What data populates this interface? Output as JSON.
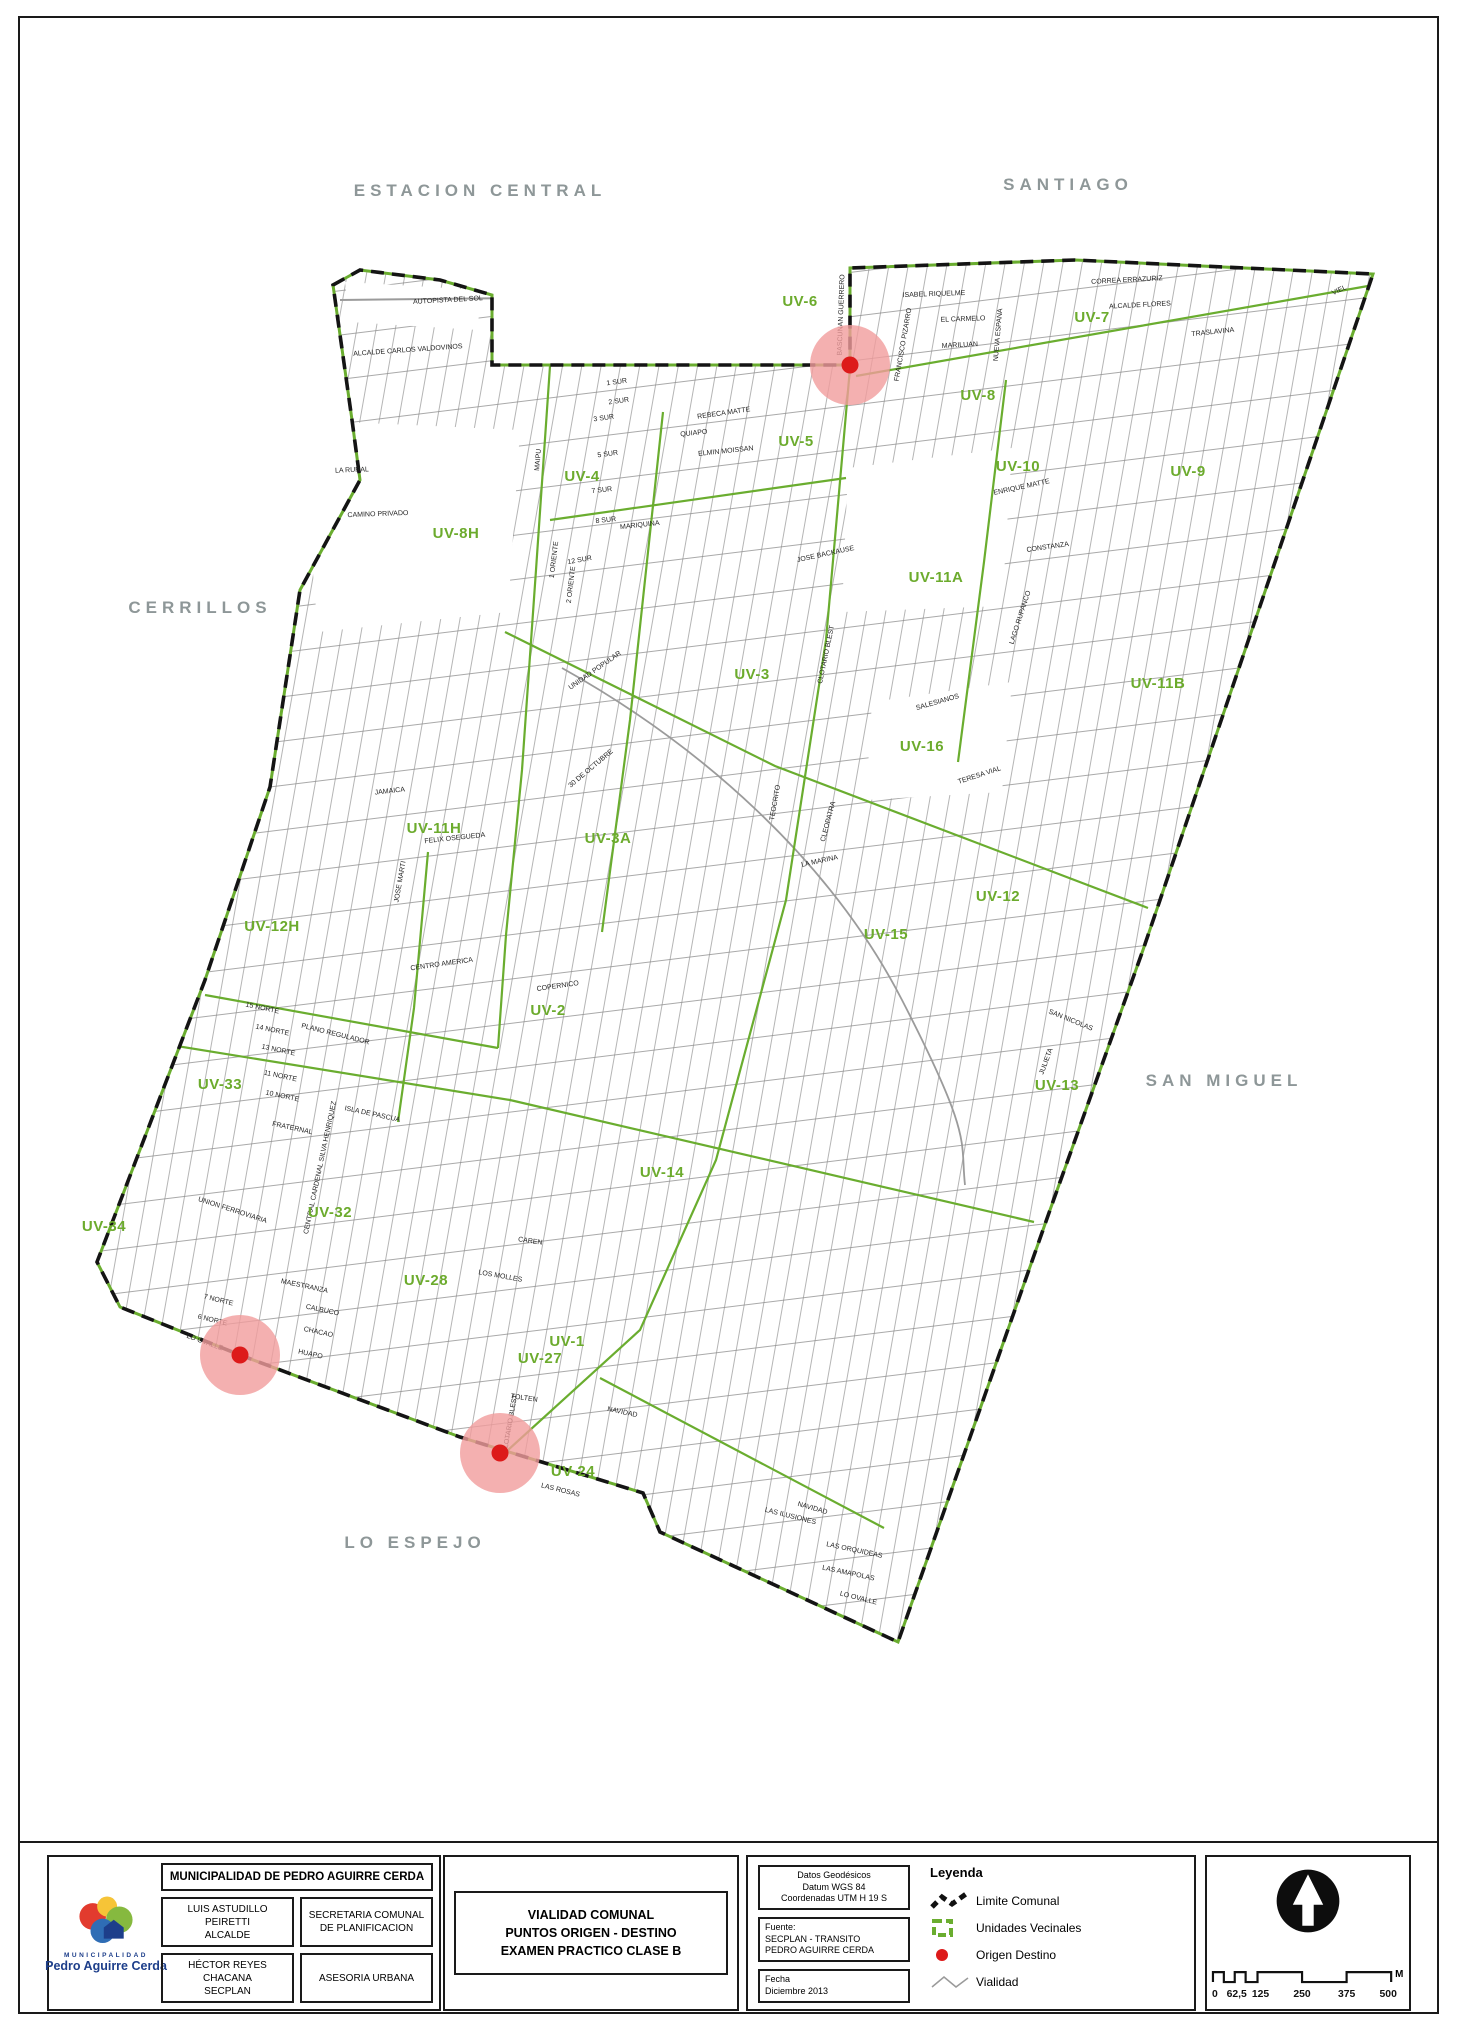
{
  "map": {
    "colors": {
      "boundary": "#141414",
      "uv_line": "#6aad2f",
      "uv_label": "#6cab2d",
      "street": "#8c8c8c",
      "area_label": "#8e9798",
      "origin_dot": "#dd1a1a",
      "origin_halo": "#f19c9c"
    },
    "area_labels": [
      {
        "t": "ESTACION CENTRAL",
        "x": 480,
        "y": 196
      },
      {
        "t": "SANTIAGO",
        "x": 1068,
        "y": 190
      },
      {
        "t": "CERRILLOS",
        "x": 200,
        "y": 613
      },
      {
        "t": "SAN MIGUEL",
        "x": 1224,
        "y": 1086
      },
      {
        "t": "LO ESPEJO",
        "x": 415,
        "y": 1548
      }
    ],
    "uv_labels": [
      {
        "t": "UV-6",
        "x": 800,
        "y": 306
      },
      {
        "t": "UV-7",
        "x": 1092,
        "y": 322
      },
      {
        "t": "UV-8",
        "x": 978,
        "y": 400
      },
      {
        "t": "UV-5",
        "x": 796,
        "y": 446
      },
      {
        "t": "UV-10",
        "x": 1018,
        "y": 471
      },
      {
        "t": "UV-9",
        "x": 1188,
        "y": 476
      },
      {
        "t": "UV-4",
        "x": 582,
        "y": 481
      },
      {
        "t": "UV-8H",
        "x": 456,
        "y": 538
      },
      {
        "t": "UV-11A",
        "x": 936,
        "y": 582
      },
      {
        "t": "UV-11B",
        "x": 1158,
        "y": 688
      },
      {
        "t": "UV-3",
        "x": 752,
        "y": 679
      },
      {
        "t": "UV-16",
        "x": 922,
        "y": 751
      },
      {
        "t": "UV-11H",
        "x": 434,
        "y": 833
      },
      {
        "t": "UV-3A",
        "x": 608,
        "y": 843
      },
      {
        "t": "UV-12H",
        "x": 272,
        "y": 931
      },
      {
        "t": "UV-2",
        "x": 548,
        "y": 1015
      },
      {
        "t": "UV-12",
        "x": 998,
        "y": 901
      },
      {
        "t": "UV-15",
        "x": 886,
        "y": 939
      },
      {
        "t": "UV-13",
        "x": 1057,
        "y": 1090
      },
      {
        "t": "UV-33",
        "x": 220,
        "y": 1089
      },
      {
        "t": "UV-14",
        "x": 662,
        "y": 1177
      },
      {
        "t": "UV-32",
        "x": 330,
        "y": 1217
      },
      {
        "t": "UV-28",
        "x": 426,
        "y": 1285
      },
      {
        "t": "UV-34",
        "x": 104,
        "y": 1231
      },
      {
        "t": "UV-1",
        "x": 567,
        "y": 1346
      },
      {
        "t": "UV-27",
        "x": 540,
        "y": 1363
      },
      {
        "t": "UV-24",
        "x": 573,
        "y": 1476
      }
    ],
    "origin_points": [
      {
        "x": 850,
        "y": 365
      },
      {
        "x": 240,
        "y": 1355
      },
      {
        "x": 500,
        "y": 1453
      }
    ],
    "street_labels": [
      {
        "t": "AUTOPISTA DEL SOL",
        "x": 448,
        "y": 302,
        "r": -3
      },
      {
        "t": "ALCALDE CARLOS VALDOVINOS",
        "x": 408,
        "y": 352,
        "r": -4
      },
      {
        "t": "CAMINO PRIVADO",
        "x": 378,
        "y": 516,
        "r": -2
      },
      {
        "t": "LA RURAL",
        "x": 352,
        "y": 472,
        "r": -2
      },
      {
        "t": "MAIPU",
        "x": 540,
        "y": 460,
        "r": -85
      },
      {
        "t": "1 ORIENTE",
        "x": 556,
        "y": 560,
        "r": -83
      },
      {
        "t": "2 ORIENTE",
        "x": 573,
        "y": 585,
        "r": -83
      },
      {
        "t": "1 SUR",
        "x": 617,
        "y": 384,
        "r": -8
      },
      {
        "t": "2 SUR",
        "x": 619,
        "y": 403,
        "r": -8
      },
      {
        "t": "3 SUR",
        "x": 604,
        "y": 420,
        "r": -8
      },
      {
        "t": "5 SUR",
        "x": 608,
        "y": 456,
        "r": -8
      },
      {
        "t": "7 SUR",
        "x": 602,
        "y": 492,
        "r": -6
      },
      {
        "t": "8 SUR",
        "x": 606,
        "y": 522,
        "r": -6
      },
      {
        "t": "12 SUR",
        "x": 580,
        "y": 562,
        "r": -10
      },
      {
        "t": "MARIQUINA",
        "x": 640,
        "y": 527,
        "r": -6
      },
      {
        "t": "REBECA MATTE",
        "x": 724,
        "y": 415,
        "r": -8
      },
      {
        "t": "ELMIN MOISSAN",
        "x": 726,
        "y": 453,
        "r": -6
      },
      {
        "t": "QUIAPO",
        "x": 694,
        "y": 435,
        "r": -6
      },
      {
        "t": "ISABEL RIQUELME",
        "x": 934,
        "y": 296,
        "r": -2
      },
      {
        "t": "EL CARMELO",
        "x": 963,
        "y": 321,
        "r": -2
      },
      {
        "t": "MARILUAN",
        "x": 960,
        "y": 347,
        "r": -3
      },
      {
        "t": "FRANCISCO PIZARRO",
        "x": 905,
        "y": 345,
        "r": -80
      },
      {
        "t": "NUEVA ESPANA",
        "x": 1000,
        "y": 335,
        "r": -85
      },
      {
        "t": "BASCUNAN GUERRERO",
        "x": 843,
        "y": 315,
        "r": -88
      },
      {
        "t": "CORREA ERRAZURIZ",
        "x": 1127,
        "y": 282,
        "r": -3
      },
      {
        "t": "ALCALDE FLORES",
        "x": 1140,
        "y": 307,
        "r": -3
      },
      {
        "t": "TRASLAVINA",
        "x": 1213,
        "y": 334,
        "r": -6
      },
      {
        "t": "VIEL",
        "x": 1340,
        "y": 292,
        "r": -25
      },
      {
        "t": "ENRIQUE MATTE",
        "x": 1022,
        "y": 489,
        "r": -12
      },
      {
        "t": "CONSTANZA",
        "x": 1048,
        "y": 549,
        "r": -8
      },
      {
        "t": "LAGO RUPANCO",
        "x": 1022,
        "y": 618,
        "r": -72
      },
      {
        "t": "SALESIANOS",
        "x": 938,
        "y": 704,
        "r": -16
      },
      {
        "t": "JOSE BACKAUSE",
        "x": 826,
        "y": 556,
        "r": -12
      },
      {
        "t": "CLOTARIO BLEST",
        "x": 828,
        "y": 655,
        "r": -78
      },
      {
        "t": "TERESA VIAL",
        "x": 980,
        "y": 777,
        "r": -18
      },
      {
        "t": "LA MARINA",
        "x": 820,
        "y": 863,
        "r": -12
      },
      {
        "t": "TEOCRITO",
        "x": 777,
        "y": 803,
        "r": -80
      },
      {
        "t": "CLEOPATRA",
        "x": 830,
        "y": 822,
        "r": -75
      },
      {
        "t": "30 DE OCTUBRE",
        "x": 592,
        "y": 770,
        "r": -40
      },
      {
        "t": "UNIDAD POPULAR",
        "x": 596,
        "y": 672,
        "r": -35
      },
      {
        "t": "JAMAICA",
        "x": 390,
        "y": 793,
        "r": -6
      },
      {
        "t": "FELIX OSEGUEDA",
        "x": 455,
        "y": 840,
        "r": -6
      },
      {
        "t": "CENTRO AMERICA",
        "x": 442,
        "y": 966,
        "r": -8
      },
      {
        "t": "COPERNICO",
        "x": 558,
        "y": 988,
        "r": -8
      },
      {
        "t": "JOSE MARTI",
        "x": 402,
        "y": 882,
        "r": -80
      },
      {
        "t": "PLANO REGULADOR",
        "x": 335,
        "y": 1036,
        "r": 14
      },
      {
        "t": "CENTRAL CARDENAL SILVA HENRIQUEZ",
        "x": 322,
        "y": 1168,
        "r": -78
      },
      {
        "t": "ISLA DE PASCUA",
        "x": 372,
        "y": 1116,
        "r": 12
      },
      {
        "t": "FRATERNAL",
        "x": 292,
        "y": 1130,
        "r": 12
      },
      {
        "t": "UNION FERROVIARIA",
        "x": 232,
        "y": 1212,
        "r": 18
      },
      {
        "t": "MAESTRANZA",
        "x": 304,
        "y": 1288,
        "r": 12
      },
      {
        "t": "CALBUCO",
        "x": 322,
        "y": 1312,
        "r": 12
      },
      {
        "t": "CHACAO",
        "x": 318,
        "y": 1334,
        "r": 12
      },
      {
        "t": "HUAPO",
        "x": 310,
        "y": 1356,
        "r": 12
      },
      {
        "t": "LO OVALLE",
        "x": 204,
        "y": 1344,
        "r": 20
      },
      {
        "t": "SAN NICOLAS",
        "x": 1070,
        "y": 1022,
        "r": 22
      },
      {
        "t": "JULIETA",
        "x": 1048,
        "y": 1062,
        "r": -70
      },
      {
        "t": "LOS MOLLES",
        "x": 500,
        "y": 1278,
        "r": 10
      },
      {
        "t": "CAREN",
        "x": 530,
        "y": 1243,
        "r": 8
      },
      {
        "t": "NAVIDAD",
        "x": 622,
        "y": 1414,
        "r": 12
      },
      {
        "t": "TOLTEN",
        "x": 524,
        "y": 1400,
        "r": 8
      },
      {
        "t": "LAS ROSAS",
        "x": 560,
        "y": 1492,
        "r": 14
      },
      {
        "t": "CLOTARIO BLEST",
        "x": 512,
        "y": 1424,
        "r": -80
      },
      {
        "t": "LAS ILUSIONES",
        "x": 790,
        "y": 1518,
        "r": 14
      },
      {
        "t": "LAS ORQUIDEAS",
        "x": 854,
        "y": 1552,
        "r": 12
      },
      {
        "t": "LAS AMAPOLAS",
        "x": 848,
        "y": 1575,
        "r": 12
      },
      {
        "t": "LO OVALLE",
        "x": 858,
        "y": 1600,
        "r": 14
      },
      {
        "t": "NAVIDAD",
        "x": 812,
        "y": 1510,
        "r": 16
      },
      {
        "t": "15 NORTE",
        "x": 262,
        "y": 1010,
        "r": 12
      },
      {
        "t": "14 NORTE",
        "x": 272,
        "y": 1032,
        "r": 12
      },
      {
        "t": "13 NORTE",
        "x": 278,
        "y": 1052,
        "r": 12
      },
      {
        "t": "11 NORTE",
        "x": 280,
        "y": 1078,
        "r": 12
      },
      {
        "t": "10 NORTE",
        "x": 282,
        "y": 1098,
        "r": 12
      },
      {
        "t": "7 NORTE",
        "x": 218,
        "y": 1302,
        "r": 14
      },
      {
        "t": "6 NORTE",
        "x": 212,
        "y": 1322,
        "r": 14
      }
    ]
  },
  "titleblock": {
    "logo_line1": "MUNICIPALIDAD",
    "logo_line2": "Pedro Aguirre Cerda",
    "municipality_header": "MUNICIPALIDAD DE PEDRO AGUIRRE CERDA",
    "officials": [
      {
        "name": "LUIS ASTUDILLO PEIRETTI",
        "role": "ALCALDE"
      },
      {
        "name": "HÉCTOR REYES CHACANA",
        "role": "SECPLAN"
      }
    ],
    "departments": [
      "SECRETARIA COMUNAL DE PLANIFICACION",
      "ASESORIA URBANA"
    ],
    "title_lines": [
      "VIALIDAD COMUNAL",
      "PUNTOS ORIGEN - DESTINO",
      "EXAMEN PRACTICO CLASE B"
    ],
    "meta_boxes": [
      {
        "lines": [
          "Datos Geodésicos",
          "Datum WGS 84",
          "Coordenadas UTM H 19 S"
        ]
      },
      {
        "lines": [
          "Fuente:",
          "SECPLAN - TRANSITO",
          "PEDRO AGUIRRE CERDA"
        ]
      },
      {
        "lines": [
          "Fecha",
          "Diciembre 2013"
        ]
      }
    ],
    "legend": {
      "title": "Leyenda",
      "items": [
        {
          "icon": "dashed-zigzag",
          "label": "Limite Comunal"
        },
        {
          "icon": "green-square",
          "label": "Unidades Vecinales"
        },
        {
          "icon": "red-dot",
          "label": "Origen Destino"
        },
        {
          "icon": "gray-zigzag",
          "label": "Vialidad"
        }
      ]
    },
    "scalebar": {
      "labels": [
        "0",
        "62,5",
        "125",
        "250",
        "375",
        "500"
      ],
      "unit": "M"
    }
  }
}
